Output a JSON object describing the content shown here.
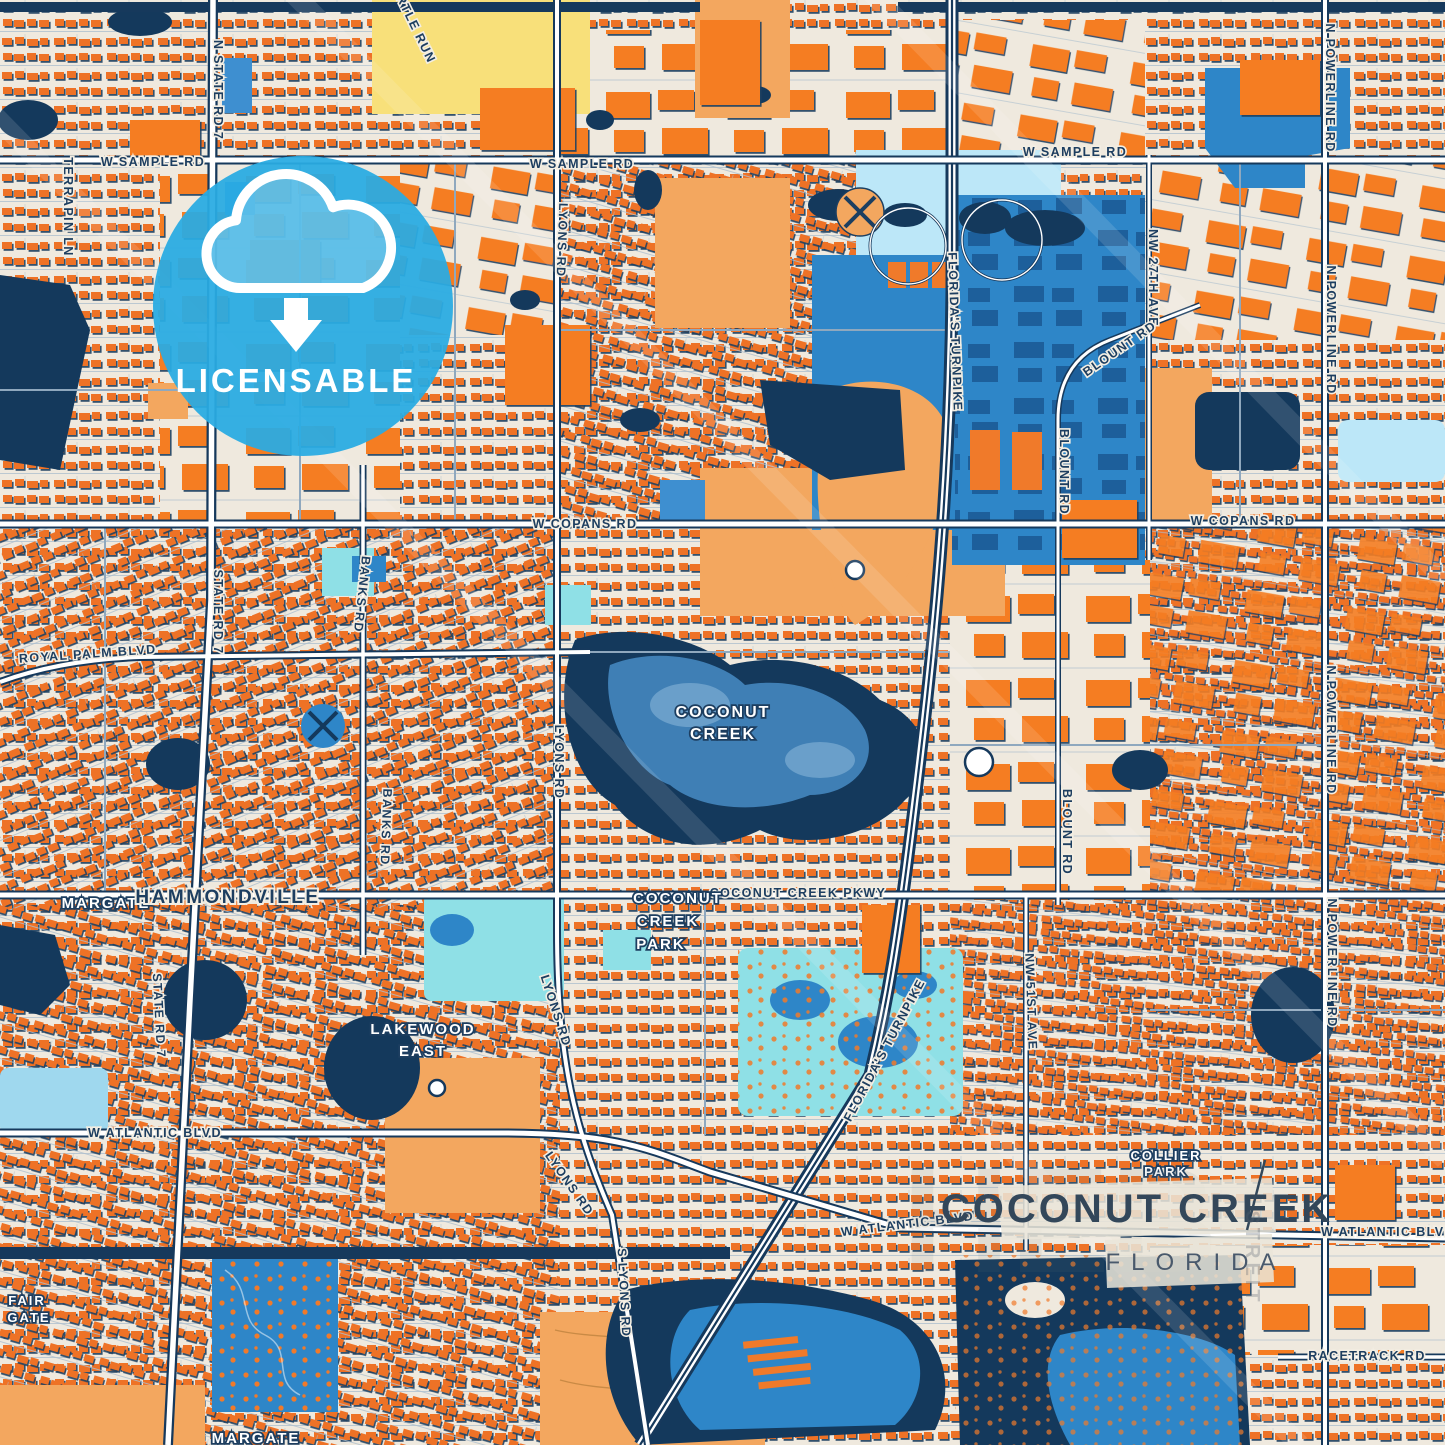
{
  "palette": {
    "background": "#EFE9DE",
    "building_orange": "#EE7226",
    "building_shadow": "#1C3F61",
    "navy_water": "#14395C",
    "water_blue": "#2E86C8",
    "light_blue": "#BCE7F8",
    "turquoise": "#8FE0E6",
    "tan": "#F3A75F",
    "yellow": "#F8E07A",
    "road_white": "#FFFFFF",
    "badge_blue": "#29ABE2",
    "title_text": "#33475A",
    "label_navy": "#1D3E60"
  },
  "badge": {
    "label": "LICENSABLE",
    "icon": "cloud-download-icon"
  },
  "title_block": {
    "city": "COCONUT CREEK",
    "state": "FLORIDA"
  },
  "watermark": {
    "text": "STREIT"
  },
  "road_labels": [
    {
      "text": "W SAMPLE RD"
    },
    {
      "text": "W SAMPLE RD"
    },
    {
      "text": "W SAMPLE RD"
    },
    {
      "text": "W COPANS RD"
    },
    {
      "text": "W COPANS RD"
    },
    {
      "text": "ROYAL PALM BLVD"
    },
    {
      "text": "COCONUT CREEK PKWY"
    },
    {
      "text": "W ATLANTIC BLVD"
    },
    {
      "text": "W ATLANTIC BLVD"
    },
    {
      "text": "W ATLANTIC BLVD"
    },
    {
      "text": "RACETRACK RD"
    },
    {
      "text": "N STATE RD 7"
    },
    {
      "text": "STATE RD 7"
    },
    {
      "text": "STATE RD 7"
    },
    {
      "text": "TERRAPIN LN"
    },
    {
      "text": "TURTLE RUN"
    },
    {
      "text": "LYONS RD"
    },
    {
      "text": "BANKS RD"
    },
    {
      "text": "BANKS RD"
    },
    {
      "text": "LYONS RD"
    },
    {
      "text": "LYONS RD"
    },
    {
      "text": "LYONS RD"
    },
    {
      "text": "S LYONS RD"
    },
    {
      "text": "FLORIDA'S TURNPIKE"
    },
    {
      "text": "FLORIDA'S TURNPIKE"
    },
    {
      "text": "N POWERLINE RD"
    },
    {
      "text": "N POWERLINE RD"
    },
    {
      "text": "N POWERLINE RD"
    },
    {
      "text": "N POWERLINE RD"
    },
    {
      "text": "NW 27TH AVE"
    },
    {
      "text": "BLOUNT RD"
    },
    {
      "text": "BLOUNT RD"
    },
    {
      "text": "BLOUNT RD"
    },
    {
      "text": "NW 51ST AVE"
    }
  ],
  "place_labels": [
    {
      "lines": [
        "MARGATE"
      ]
    },
    {
      "lines": [
        "HAMMONDVILLE"
      ]
    },
    {
      "lines": [
        "COCONUT",
        "CREEK"
      ]
    },
    {
      "lines": [
        "COCONUT",
        "CREEK",
        "PARK"
      ]
    },
    {
      "lines": [
        "LAKEWOOD",
        "EAST"
      ]
    },
    {
      "lines": [
        "FAIR",
        "GATE"
      ]
    },
    {
      "lines": [
        "COLLIER",
        "PARK"
      ]
    },
    {
      "lines": [
        "MARGATE"
      ]
    }
  ]
}
